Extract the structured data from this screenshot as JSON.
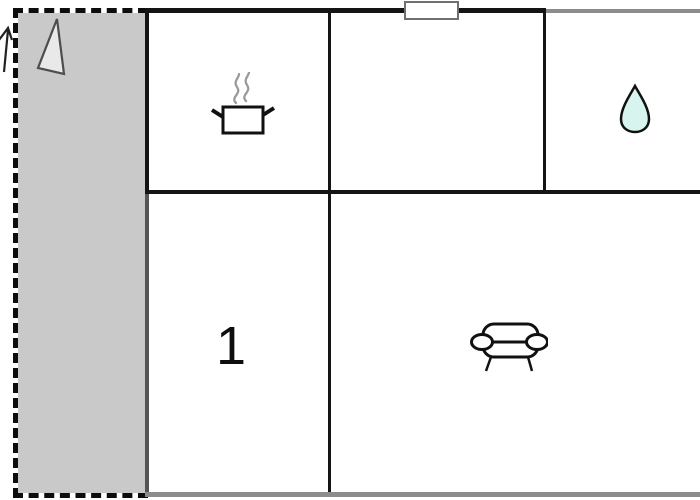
{
  "plan": {
    "kind": "apartment-floor-plan",
    "colors": {
      "background": "#ffffff",
      "wall": "#141414",
      "wall-gray": "#8c8c8c",
      "wall-dark-gray": "#555555",
      "terrace-fill": "#c9c9c9",
      "triangle-fill": "#e9e9e9",
      "triangle-stroke": "#4d4d4d",
      "drop-fill": "#d8f4ee",
      "steam": "#9b9b9b",
      "window-border": "#707070"
    },
    "terrace": {
      "icon": "north-triangle-icon"
    },
    "north_arrow": {
      "icon": "north-arrow-icon"
    },
    "window": {
      "position": "top-wall"
    },
    "rooms": {
      "kitchen": {
        "icon": "cooking-pot-icon"
      },
      "middle": {
        "icon": ""
      },
      "bathroom": {
        "icon": "water-drop-icon"
      },
      "bedroom": {
        "label": "1"
      },
      "living": {
        "icon": "sofa-icon"
      }
    }
  }
}
